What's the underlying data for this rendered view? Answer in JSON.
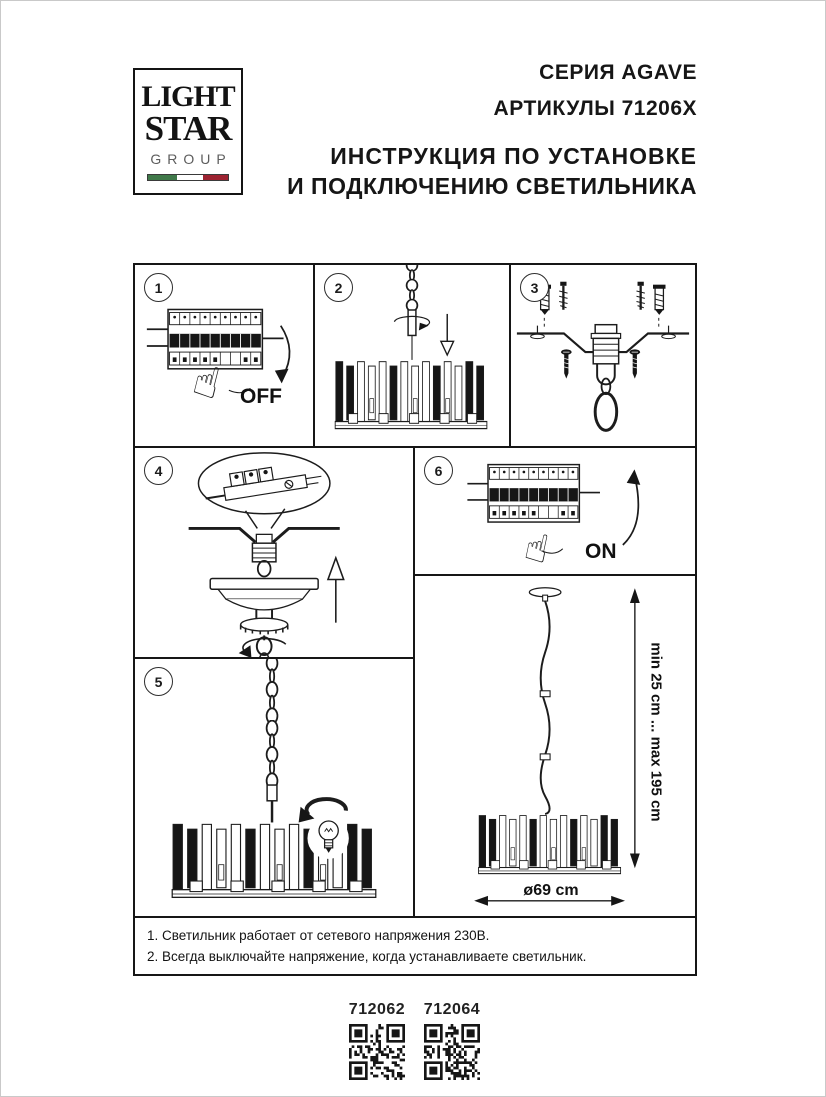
{
  "header": {
    "logo": {
      "line1": "LIGHT",
      "line2": "STAR",
      "line3": "GROUP",
      "flag_colors": {
        "green": "#40794a",
        "white": "#ffffff",
        "red": "#9d2331"
      }
    },
    "series": "СЕРИЯ AGAVE",
    "articles": "АРТИКУЛЫ 71206X",
    "instruction_line1": "ИНСТРУКЦИЯ ПО УСТАНОВКЕ",
    "instruction_line2": "И ПОДКЛЮЧЕНИЮ СВЕТИЛЬНИКА"
  },
  "icons": {
    "hand": "☝"
  },
  "steps": {
    "step1": {
      "number": "1",
      "label": "OFF"
    },
    "step2": {
      "number": "2"
    },
    "step3": {
      "number": "3"
    },
    "step4": {
      "number": "4"
    },
    "step5": {
      "number": "5"
    },
    "step6": {
      "number": "6",
      "label": "ON"
    }
  },
  "dimensions": {
    "height_range": "min 25 cm ... max 195 cm",
    "diameter": "ø69 cm"
  },
  "notes": [
    "1. Светильник работает от сетевого напряжения 230В.",
    "2. Всегда выключайте напряжение, когда устанавливаете светильник."
  ],
  "footer": {
    "articles": [
      "712062",
      "712064"
    ]
  }
}
